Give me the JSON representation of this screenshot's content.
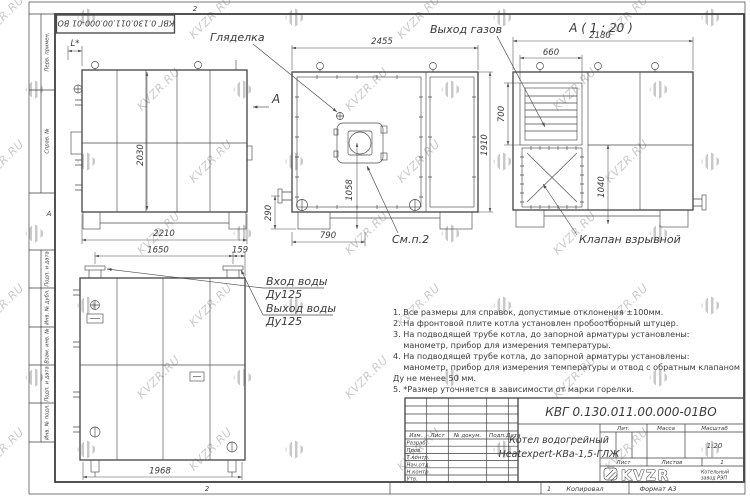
{
  "frame": {
    "doc_number_rotated": "КВГ 0.130.011.00.000-01 ВО",
    "left_strip": [
      "Перв. примен.",
      "Справ. №",
      "Подп. и дата",
      "Инв. № дубл.",
      "Взам. инв. №",
      "Подп. и дата",
      "Инв. № подл."
    ],
    "zone_top": "2",
    "zone_left": "А",
    "zone_bottom": "2",
    "sheet_zone": "1",
    "kopiroval": "Копировал",
    "format": "Формат А3"
  },
  "views": {
    "side": {
      "l_star": "L*",
      "h2030": "2030",
      "w2210": "2210",
      "section": "А"
    },
    "front": {
      "w2455": "2455",
      "h1910": "1910",
      "d1058": "1058",
      "d790": "790",
      "d290": "290",
      "sight": "Гляделка",
      "note": "См.п.2"
    },
    "a": {
      "title": "А ( 1 : 20 )",
      "gas": "Выход газов",
      "w2180": "2180",
      "louver_w": "660",
      "louver_h": "700",
      "d1040": "1040",
      "valve": "Клапан взрывной"
    },
    "bottom": {
      "d1650": "1650",
      "d159": "159",
      "d1968": "1968",
      "in1": "Вход воды",
      "in2": "Ду125",
      "out1": "Выход воды",
      "out2": "Ду125"
    }
  },
  "notes": [
    "1. Все размеры для справок, допустимые отклонения ±100мм.",
    "2. На фронтовой плите котла установлен пробоотборный штуцер.",
    "3. На подводящей трубе котла, до запорной арматуры установлены:",
    "    манометр, прибор для измерения температуры.",
    "4. На подводящей трубе котла, до запорной арматуры установлены:",
    "    манометр, прибор для измерения температуры и отвод с обратным клапаном",
    "Ду не менее 50 мм.",
    "5. *Размер уточняется в зависимости от марки горелки."
  ],
  "titleblock": {
    "designation": "КВГ 0.130.011.00.000-01ВО",
    "name_line1": "Котел водогрейный",
    "name_line2": "Heatexpert-КВа-1,5-ГЛЖ",
    "headers": {
      "lit": "Лит.",
      "mass": "Масса",
      "scale": "Масштаб"
    },
    "scale_value": "1:20",
    "sheet_label": "Лист",
    "sheets_label": "Листов",
    "sheets_value": "1",
    "cols": [
      "Изм.",
      "Лист",
      "№ докум.",
      "Подп.",
      "Дата"
    ],
    "sign_rows": [
      "Разраб.",
      "Пров.",
      "Т.контр.",
      "Нач.отд.",
      "Н.контр.",
      "Утв."
    ],
    "logo": {
      "letters": "KVZR",
      "sub1": "Котельный",
      "sub2": "завод РЭП"
    }
  },
  "watermark": {
    "text": "KVZR.RU"
  }
}
